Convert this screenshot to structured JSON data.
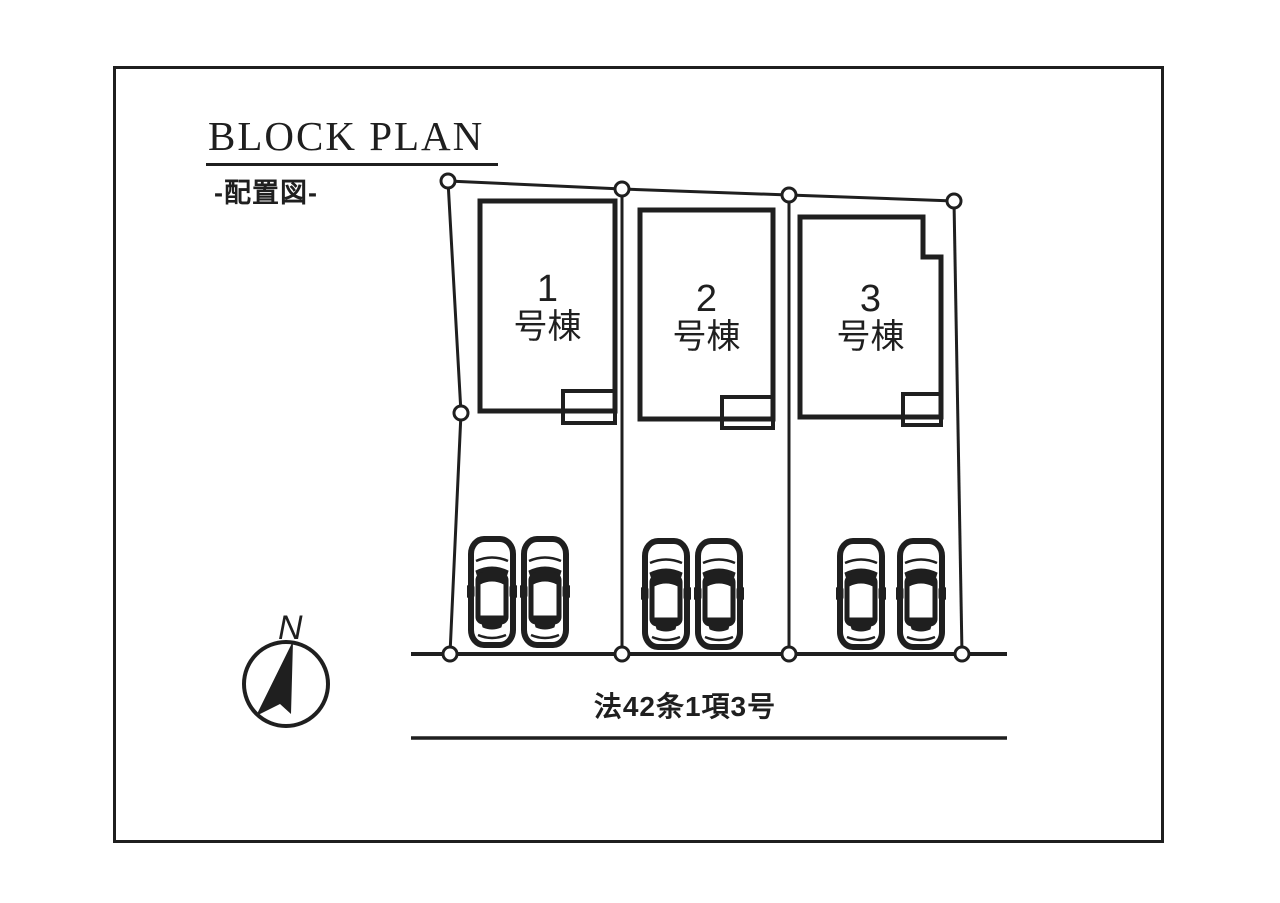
{
  "page": {
    "title": "BLOCK PLAN",
    "subtitle": "-配置図-"
  },
  "plan": {
    "buildings": [
      {
        "number": "1",
        "suffix": "号棟"
      },
      {
        "number": "2",
        "suffix": "号棟"
      },
      {
        "number": "3",
        "suffix": "号棟"
      }
    ],
    "road_label": "法42条1項3号",
    "compass": {
      "north_label": "N"
    },
    "parking": {
      "cars_per_lot": 2,
      "total_cars": 6
    },
    "colors": {
      "ink": "#1f1f1f",
      "background": "#ffffff"
    }
  }
}
